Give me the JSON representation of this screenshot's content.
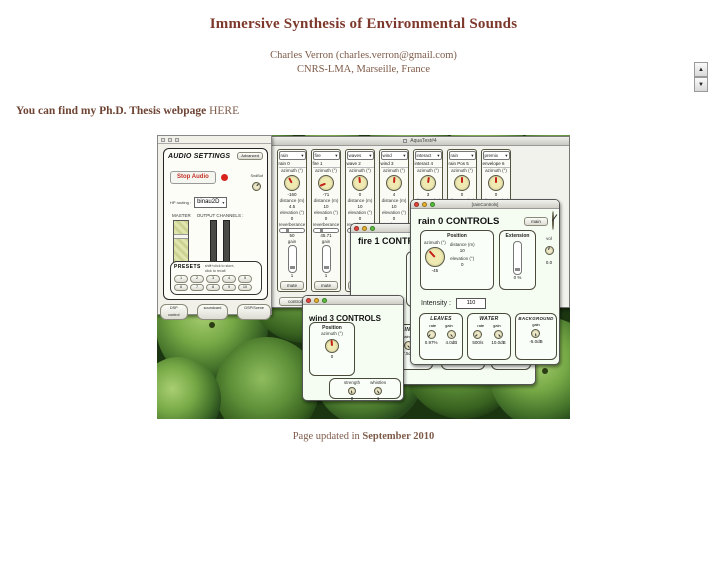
{
  "page": {
    "title": "Immersive Synthesis of Environmental Sounds",
    "author": "Charles Verron (charles.verron@gmail.com)",
    "affiliation": "CNRS-LMA, Marseille, France",
    "thesis_prefix": "You can find my Ph.D. Thesis webpage",
    "thesis_link": "HERE",
    "updated_prefix": "Page updated in",
    "updated_date": "September 2010",
    "colors": {
      "heading": "#7c382a",
      "body_text": "#7d5a48",
      "accent_red": "#c32019"
    }
  },
  "icons": {
    "up_arrow": "▲",
    "down_arrow": "▼",
    "caret": "▾"
  },
  "shot": {
    "main_window": {
      "titlebar": "AquaTest#4",
      "controls_button": "controls",
      "mute_label": "mute",
      "strips": [
        {
          "menu": "rain",
          "name": "rain 0",
          "azimuth_label": "azimuth (°)",
          "azimuth": "-160",
          "needle": -28,
          "distance_label": "distance (m)",
          "distance": "4.5",
          "elevation_label": "elevation (°)",
          "elevation": "0",
          "reverb_label": "reverberance",
          "reverb": "50",
          "gain_label": "gain",
          "gain": "1"
        },
        {
          "menu": "fire",
          "name": "fire 1",
          "azimuth_label": "azimuth (°)",
          "azimuth": "-71",
          "needle": -112,
          "distance_label": "distance (m)",
          "distance": "10",
          "elevation_label": "elevation (°)",
          "elevation": "0",
          "reverb_label": "reverberance",
          "reverb": "45.71",
          "gain_label": "gain",
          "gain": "1"
        },
        {
          "menu": "waves",
          "name": "wave 2",
          "azimuth_label": "azimuth (°)",
          "azimuth": "0",
          "needle": -6,
          "distance_label": "distance (m)",
          "distance": "10",
          "elevation_label": "elevation (°)",
          "elevation": "0",
          "reverb_label": "reverberance",
          "reverb": "12",
          "gain_label": "gain",
          "gain": "1"
        },
        {
          "menu": "wind",
          "name": "wind 3",
          "azimuth_label": "azimuth (°)",
          "azimuth": "4",
          "needle": 4,
          "distance_label": "distance (m)",
          "distance": "10",
          "elevation_label": "elevation (°)",
          "elevation": "0",
          "reverb_label": "reverberance",
          "reverb": "50",
          "gain_label": "gain",
          "gain": "1"
        },
        {
          "menu": "interact",
          "name": "interact 4",
          "azimuth_label": "azimuth (°)",
          "azimuth": "3",
          "needle": 8,
          "distance_label": "distance (m)",
          "distance": "10",
          "elevation_label": "elevation (°)",
          "elevation": "0",
          "reverb_label": "reverberance",
          "reverb": "50",
          "gain_label": "gain",
          "gain": "1"
        },
        {
          "menu": "rain",
          "name": "rain Pos 5",
          "azimuth_label": "azimuth (°)",
          "azimuth": "0",
          "needle": 0,
          "distance_label": "distance (m)",
          "distance": "4.5",
          "elevation_label": "elevation (°)",
          "elevation": "0",
          "reverb_label": "reverberance",
          "reverb": "50",
          "gain_label": "gain",
          "gain": "1"
        },
        {
          "menu": "premix",
          "name": "envelope 6",
          "azimuth_label": "azimuth (°)",
          "azimuth": "0",
          "needle": 0,
          "distance_label": "distance (m)",
          "distance": "10",
          "elevation_label": "elevation (°)",
          "elevation": "0",
          "reverb_label": "reverberance",
          "reverb": "50",
          "gain_label": "gain",
          "gain": "1"
        }
      ]
    },
    "audio": {
      "title": "AUDIO SETTINGS",
      "advanced_button": "Advanced",
      "stop_button": "Stop Audio",
      "sndbuf_label": "SndBuf",
      "sndbuf_needle": 40,
      "hp_label": "HP routing :",
      "hp_value": "binau2D",
      "master_label": "MASTER",
      "master_min": "-inf",
      "master_max": "0",
      "outputs_label": "OUTPUT CHANNELS :",
      "out1": "1",
      "out2": "2",
      "presets_label": "PRESETS",
      "presets_note1": "shift+click to store,",
      "presets_note2": "click to recall",
      "preset_row1": [
        "1",
        "2",
        "3",
        "4",
        "5"
      ],
      "preset_row2": [
        "6",
        "7",
        "8",
        "9",
        "10"
      ],
      "pills": [
        "DSP control",
        "soundcard",
        "DSP/Scene"
      ]
    },
    "rain": {
      "titlebar": "[rainControls]",
      "heading": "rain 0 CONTROLS",
      "main_button": "main",
      "clock_needle": 35,
      "position": {
        "title": "Position",
        "azimuth_label": "azimuth (°)",
        "azimuth": "-45",
        "needle": -42,
        "distance_label": "distance (m)",
        "distance": "10",
        "elevation_label": "elevation (°)",
        "elevation": "0"
      },
      "extension": {
        "title": "Extension",
        "value": "0 %"
      },
      "vol": {
        "label": "vol",
        "value": "0.0",
        "needle": 15
      },
      "intensity_label": "Intensity :",
      "intensity": "110",
      "leaves": {
        "title": "LEAVES",
        "rate_label": "rate",
        "gain_label": "gain",
        "rate": "0.97%",
        "gain": "4.0dB",
        "rot1": -140,
        "rot2": 140
      },
      "water": {
        "title": "WATER",
        "rate_label": "rate",
        "gain_label": "gain",
        "rate": "500/s",
        "gain": "10.0dB",
        "rot1": -135,
        "rot2": 145
      },
      "background": {
        "title": "BACKGROUND",
        "gain_label": "gain",
        "gain": "-5.0dB",
        "rot": 172
      }
    },
    "fire": {
      "heading": "fire 1 CONTROLS",
      "position": {
        "title": "Position",
        "azimuth_label": "azimuth (°)",
        "azimuth": "-71",
        "needle": -115
      },
      "intensity_label": "Fire Intensity",
      "crackling": {
        "title": "CRACKLING",
        "rate_label": "rate",
        "gain_label": "gain",
        "rate": "0.50/s",
        "gain": "7.5dB",
        "rot1": -140,
        "rot2": 140
      },
      "gain_panel": {
        "label": "gain",
        "value": "-7.5dB",
        "rot": 160
      },
      "flames_panel": {
        "label": "flames",
        "value": "0.50",
        "rot": -150
      }
    },
    "wind": {
      "heading": "wind 3 CONTROLS",
      "position": {
        "title": "Position",
        "azimuth_label": "azimuth (°)",
        "azimuth": "0",
        "needle": -5
      },
      "strength": {
        "label": "strength",
        "value": "0",
        "rot": 172
      },
      "whistles": {
        "label": "whistles",
        "value": "1",
        "rot": 150
      }
    }
  }
}
